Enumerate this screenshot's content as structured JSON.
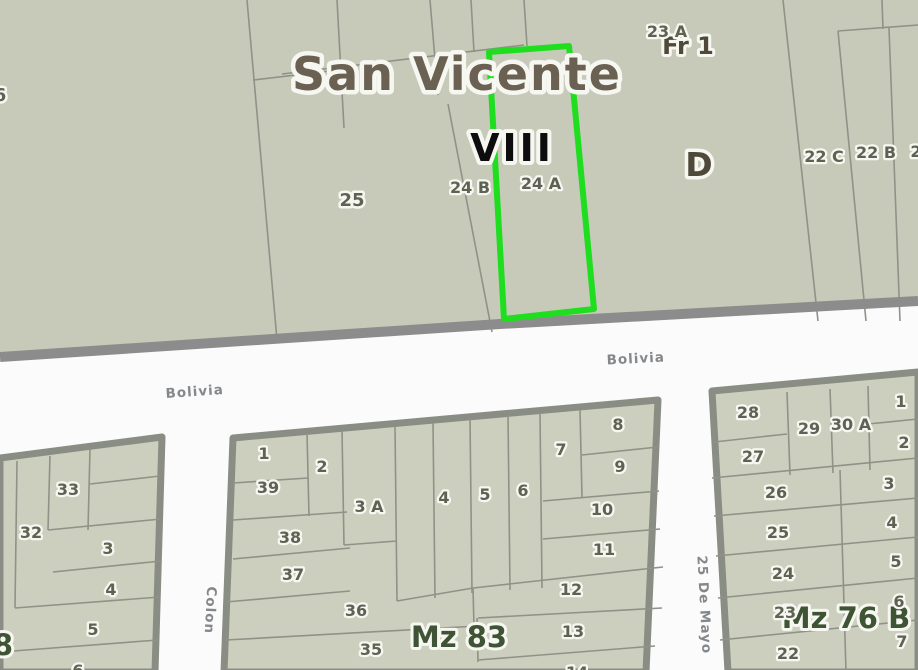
{
  "top_area": {
    "region_label": "San Vicente",
    "section_label": "VIII",
    "zone_label": "D",
    "fraction_label": "Fr 1",
    "parcel_23a": "23 A",
    "parcel_25": "25",
    "parcel_24b": "24 B",
    "parcel_24a": "24 A",
    "parcel_22c": "22 C",
    "parcel_22b": "22 B",
    "parcel_edge_right_partial": "2",
    "parcel_edge_left_partial": "6"
  },
  "streets": {
    "bolivia_left": "Bolivia",
    "bolivia_right": "Bolivia",
    "colon": "Colon",
    "de_mayo": "25 De Mayo"
  },
  "block_left": {
    "mz_partial": "8",
    "parcels": {
      "p33": "33",
      "p32": "32",
      "p3": "3",
      "p4": "4",
      "p5": "5",
      "p6": "6"
    }
  },
  "block_mid": {
    "mz": "Mz 83",
    "parcels": {
      "p1": "1",
      "p2": "2",
      "p39": "39",
      "p38": "38",
      "p37": "37",
      "p36": "36",
      "p35": "35",
      "p3a": "3 A",
      "p4": "4",
      "p5": "5",
      "p6": "6",
      "p7": "7",
      "p8": "8",
      "p9": "9",
      "p10": "10",
      "p11": "11",
      "p12": "12",
      "p13": "13",
      "p14": "14"
    }
  },
  "block_right": {
    "mz": "Mz 76 B",
    "parcels_left": {
      "p28": "28",
      "p27": "27",
      "p29": "29",
      "p30a": "30 A",
      "p26": "26",
      "p25": "25",
      "p24": "24",
      "p23": "23",
      "p22": "22"
    },
    "parcels_right": {
      "p1": "1",
      "p2": "2",
      "p3": "3",
      "p4": "4",
      "p5": "5",
      "p6": "6",
      "p7": "7"
    }
  },
  "colors": {
    "parcel_fill": "#c7cab9",
    "block_fill": "#cccfbe",
    "road_fill": "#fbfbfb",
    "road_edge_gray": "#8c8c8c",
    "boundary_line": "#8f9286",
    "block_border": "#8a8d84",
    "highlight_green": "#1fdd1f",
    "title_brown": "#6b6152",
    "label_olive": "#5d6253",
    "mz_dark_green": "#3e5434",
    "street_label_gray": "#85888b"
  }
}
